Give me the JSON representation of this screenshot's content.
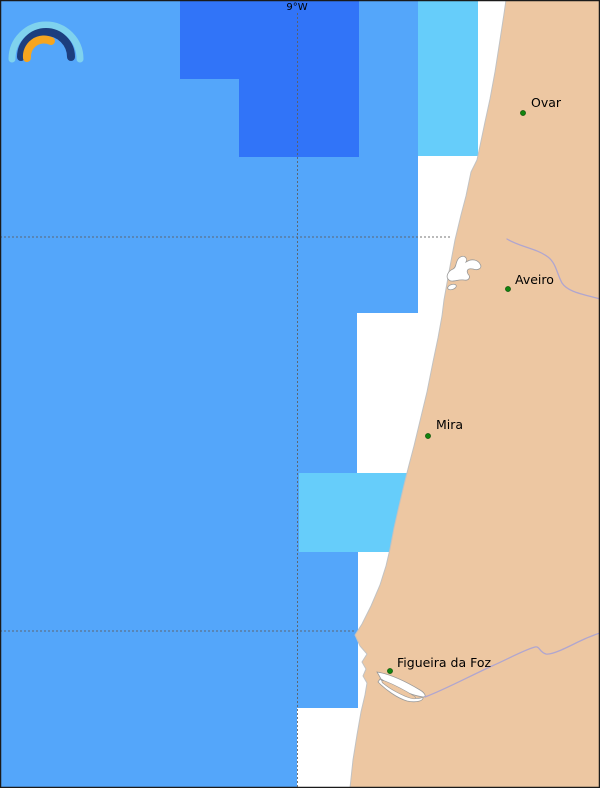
{
  "grid": {
    "lon_label": "9°W",
    "lon_line_x": 297.5,
    "lat_line_ys": [
      237,
      631
    ]
  },
  "cities": [
    {
      "id": "ovar",
      "name": "Ovar",
      "x": 523,
      "y": 113,
      "label_x": 531,
      "label_y": 107
    },
    {
      "id": "aveiro",
      "name": "Aveiro",
      "x": 508,
      "y": 289,
      "label_x": 515,
      "label_y": 284
    },
    {
      "id": "mira",
      "name": "Mira",
      "x": 428,
      "y": 436,
      "label_x": 436,
      "label_y": 429
    },
    {
      "id": "figueira-da-foz",
      "name": "Figueira da Foz",
      "x": 390,
      "y": 671,
      "label_x": 397,
      "label_y": 667
    }
  ],
  "regions": [
    {
      "id": "nodata-band-north",
      "x": 478,
      "y": 0,
      "w": 122,
      "h": 156,
      "color": "no_data"
    },
    {
      "id": "nodata-band-aveiro",
      "x": 418,
      "y": 156,
      "w": 182,
      "h": 157,
      "color": "no_data"
    },
    {
      "id": "nodata-band-mira",
      "x": 357,
      "y": 313,
      "w": 243,
      "h": 160,
      "color": "no_data"
    },
    {
      "id": "nodata-band-south",
      "x": 358,
      "y": 552,
      "w": 242,
      "h": 156,
      "color": "no_data"
    },
    {
      "id": "nodata-band-bottom",
      "x": 297,
      "y": 708,
      "w": 303,
      "h": 80,
      "color": "no_data"
    },
    {
      "id": "wave-cell-dark-north",
      "x": 180,
      "y": 0,
      "w": 179,
      "h": 79,
      "color": "ocean_dark"
    },
    {
      "id": "wave-cell-dark-south",
      "x": 239,
      "y": 79,
      "w": 120,
      "h": 78,
      "color": "ocean_dark"
    },
    {
      "id": "wave-cell-light-north",
      "x": 418,
      "y": 0,
      "w": 60,
      "h": 156,
      "color": "ocean_light"
    },
    {
      "id": "wave-cell-light-central",
      "x": 299,
      "y": 473,
      "w": 120,
      "h": 79,
      "color": "ocean_light"
    }
  ],
  "colors": {
    "ocean": "#54a6fa",
    "ocean_dark": "#3174f8",
    "ocean_light": "#66cdfa",
    "no_data": "#ffffff",
    "land": "#edc7a2",
    "city_dot": "#12830f",
    "city_dot_border": "#0a4d08",
    "river": "#b0a6cf",
    "label_text": "#000000"
  },
  "logo": {
    "arc_outer_color": "#7fd2ee",
    "arc_middle_color": "#1c3e7e",
    "arc_inner_color": "#f6a51f"
  }
}
